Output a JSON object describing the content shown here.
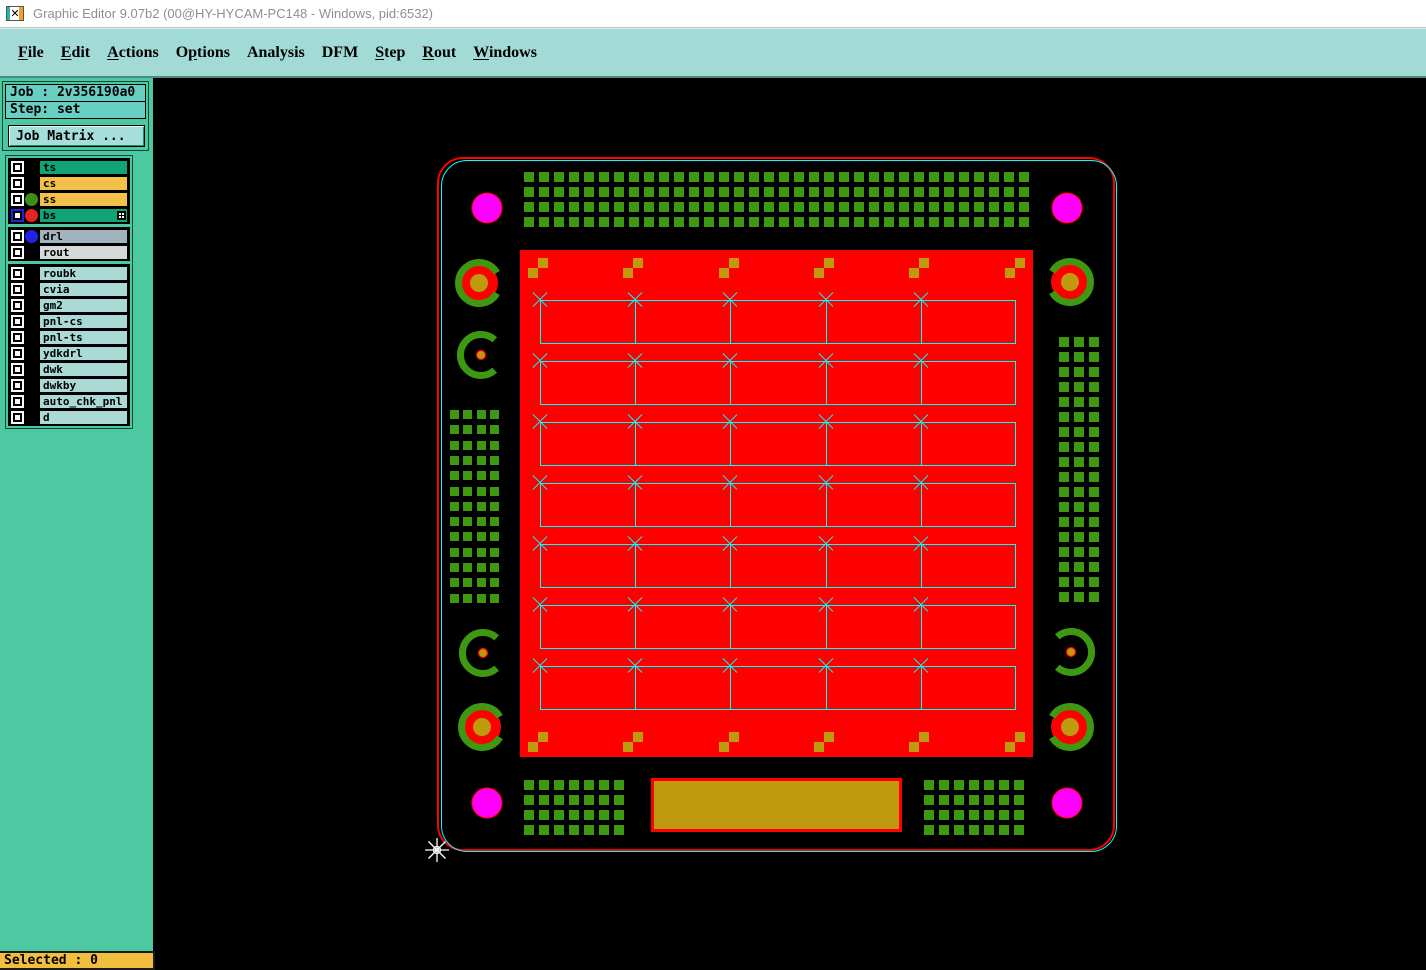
{
  "window": {
    "title": "Graphic Editor 9.07b2 (00@HY-HYCAM-PC148 - Windows, pid:6532)",
    "icon_glyph": "✕"
  },
  "menu": {
    "items": [
      {
        "label": "File",
        "underline": 0
      },
      {
        "label": "Edit",
        "underline": 0
      },
      {
        "label": "Actions",
        "underline": 0
      },
      {
        "label": "Options",
        "underline": 1
      },
      {
        "label": "Analysis",
        "underline": -1
      },
      {
        "label": "DFM",
        "underline": -1
      },
      {
        "label": "Step",
        "underline": 0
      },
      {
        "label": "Rout",
        "underline": 0
      },
      {
        "label": "Windows",
        "underline": 0
      }
    ]
  },
  "sidebar": {
    "job_line": "Job : 2v356190a0",
    "step_line": "Step: set",
    "job_matrix_button": "Job Matrix ...",
    "selected_status": "Selected : 0",
    "layer_groups": [
      {
        "rows": [
          {
            "label": "ts",
            "bar": "#10a375",
            "dot": null,
            "selected": false,
            "fill_icon": false
          },
          {
            "label": "cs",
            "bar": "#f3c04a",
            "dot": null,
            "selected": false,
            "fill_icon": false
          },
          {
            "label": "ss",
            "bar": "#f3c04a",
            "dot": "#3e8e16",
            "selected": false,
            "fill_icon": false
          },
          {
            "label": "bs",
            "bar": "#10a375",
            "dot": "#e62222",
            "selected": true,
            "fill_icon": true
          }
        ]
      },
      {
        "rows": [
          {
            "label": "drl",
            "bar": "#a1b3bd",
            "dot": "#2222e6",
            "selected": false,
            "fill_icon": false
          },
          {
            "label": "rout",
            "bar": "#d5d9d9",
            "dot": null,
            "selected": false,
            "fill_icon": false
          }
        ]
      },
      {
        "rows": [
          {
            "label": "roubk",
            "bar": "#abd9d5",
            "dot": null,
            "selected": false,
            "fill_icon": false
          },
          {
            "label": "cvia",
            "bar": "#abd9d5",
            "dot": null,
            "selected": false,
            "fill_icon": false
          },
          {
            "label": "gm2",
            "bar": "#abd9d5",
            "dot": null,
            "selected": false,
            "fill_icon": false
          },
          {
            "label": "pnl-cs",
            "bar": "#abd9d5",
            "dot": null,
            "selected": false,
            "fill_icon": false
          },
          {
            "label": "pnl-ts",
            "bar": "#abd9d5",
            "dot": null,
            "selected": false,
            "fill_icon": false
          },
          {
            "label": "ydkdrl",
            "bar": "#abd9d5",
            "dot": null,
            "selected": false,
            "fill_icon": false
          },
          {
            "label": "dwk",
            "bar": "#abd9d5",
            "dot": null,
            "selected": false,
            "fill_icon": false
          },
          {
            "label": "dwkby",
            "bar": "#abd9d5",
            "dot": null,
            "selected": false,
            "fill_icon": false
          },
          {
            "label": "auto_chk_pnl",
            "bar": "#abd9d5",
            "dot": null,
            "selected": false,
            "fill_icon": false
          },
          {
            "label": "d",
            "bar": "#abd9d5",
            "dot": null,
            "selected": false,
            "fill_icon": false
          }
        ]
      }
    ]
  },
  "pcb": {
    "colors": {
      "red": "#ff0000",
      "green": "#3e9811",
      "gold": "#bf9a0e",
      "magenta": "#ff00ff",
      "cyan": "#00ffff"
    },
    "outline_red": {
      "x": 437,
      "y": 157,
      "w": 678,
      "h": 694,
      "radius": 26
    },
    "outline_cyan": {
      "x": 441,
      "y": 160,
      "w": 676,
      "h": 692,
      "radius": 26
    },
    "panel": {
      "x": 520,
      "y": 250,
      "w": 513,
      "h": 507
    },
    "magenta_pads": [
      [
        487,
        208
      ],
      [
        1067,
        208
      ],
      [
        487,
        803
      ],
      [
        1067,
        803
      ]
    ],
    "ring_targets": [
      [
        479,
        283,
        "e"
      ],
      [
        1070,
        282,
        "w"
      ],
      [
        482,
        727,
        "e"
      ],
      [
        1070,
        727,
        "w"
      ]
    ],
    "arc_targets": [
      [
        481,
        355,
        "e"
      ],
      [
        483,
        653,
        "e"
      ],
      [
        1071,
        652,
        "w"
      ]
    ],
    "grids": [
      {
        "x": 524,
        "y": 172,
        "cols": 34,
        "rows": 4,
        "pitch_x": 15,
        "pitch_y": 15,
        "size": 10
      },
      {
        "x": 450,
        "y": 410,
        "cols": 4,
        "rows": 13,
        "pitch_x": 13.4,
        "pitch_y": 15.3,
        "size": 9
      },
      {
        "x": 1059,
        "y": 337,
        "cols": 3,
        "rows": 18,
        "pitch_x": 15,
        "pitch_y": 15,
        "size": 10
      },
      {
        "x": 524,
        "y": 780,
        "cols": 7,
        "rows": 4,
        "pitch_x": 15,
        "pitch_y": 15,
        "size": 10
      },
      {
        "x": 924,
        "y": 780,
        "cols": 7,
        "rows": 4,
        "pitch_x": 15,
        "pitch_y": 15,
        "size": 10
      }
    ],
    "fiducials": {
      "xs": [
        528,
        623,
        719,
        814,
        909,
        1005
      ],
      "top_y": 268,
      "bottom_y": 742,
      "size": 10
    },
    "cells": {
      "left": 540,
      "col_width": 95.2,
      "cols": 5,
      "cell_height": 44,
      "row_tops": [
        300,
        361,
        422,
        483,
        544,
        605,
        666
      ]
    },
    "gold_rect": {
      "x": 651,
      "y": 778,
      "w": 251,
      "h": 54
    },
    "cursor": {
      "x": 437,
      "y": 850
    }
  }
}
